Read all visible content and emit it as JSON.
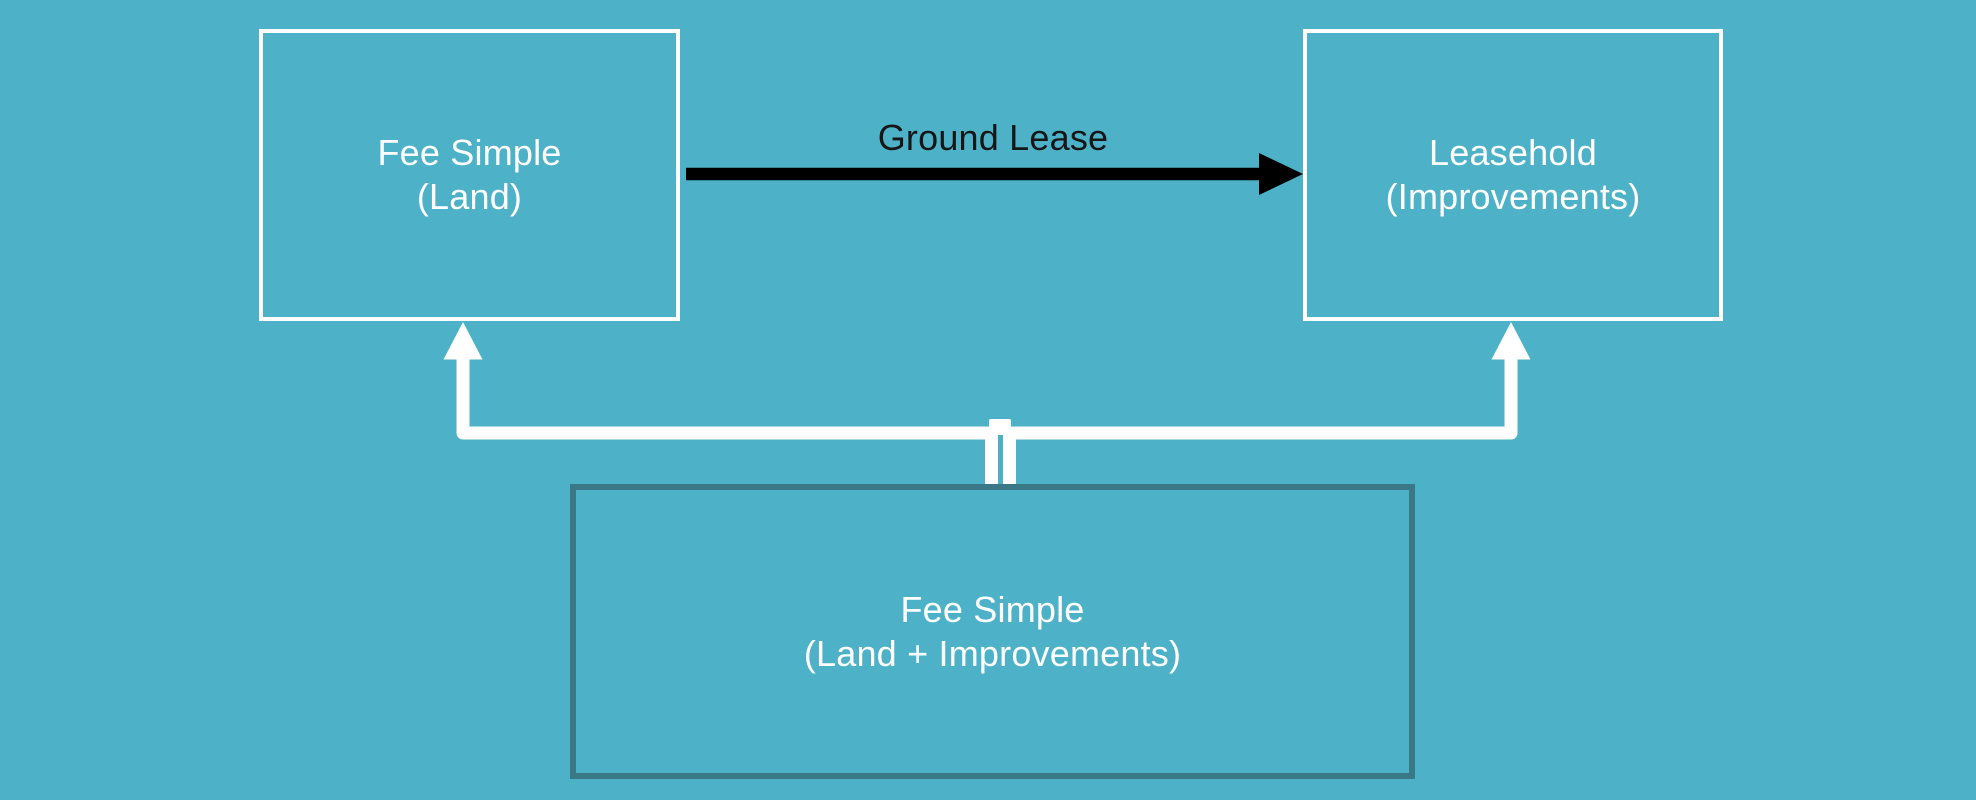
{
  "page": {
    "background_color": "#4DB2C7",
    "box_border_white": "#FFFFFF",
    "box_border_dark": "#3A7888",
    "text_color_light": "#FFFFFF",
    "text_color_dark": "#161616",
    "connector_color": "#FFFFFF",
    "arrow_color": "#000000"
  },
  "nodes": {
    "fee_simple_land": {
      "line1": "Fee Simple",
      "line2": "(Land)",
      "border_color": "#FFFFFF"
    },
    "leasehold_improvements": {
      "line1": "Leasehold",
      "line2": "(Improvements)",
      "border_color": "#FFFFFF"
    },
    "fee_simple_land_improvements": {
      "line1": "Fee Simple",
      "line2": "(Land + Improvements)",
      "border_color": "#3A7888"
    }
  },
  "edges": {
    "ground_lease": {
      "label": "Ground Lease",
      "from": "Fee Simple (Land)",
      "to": "Leasehold (Improvements)",
      "color": "#000000",
      "style": "straight-right-arrow"
    },
    "split_to_fee_simple_land": {
      "from": "Fee Simple (Land + Improvements)",
      "to": "Fee Simple (Land)",
      "color": "#FFFFFF",
      "style": "elbow-up-arrow"
    },
    "split_to_leasehold": {
      "from": "Fee Simple (Land + Improvements)",
      "to": "Leasehold (Improvements)",
      "color": "#FFFFFF",
      "style": "elbow-up-arrow"
    }
  }
}
